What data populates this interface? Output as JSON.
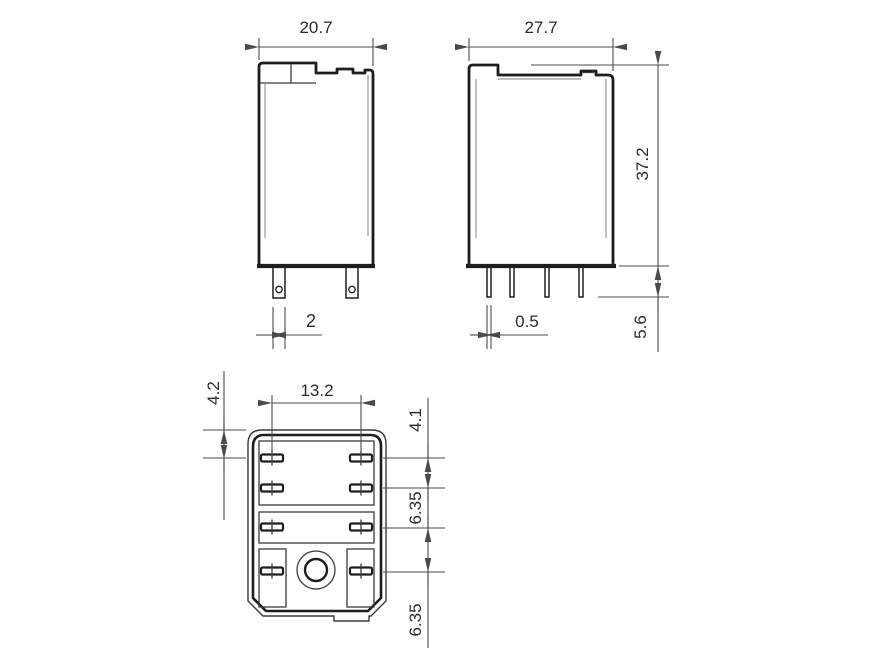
{
  "dims": {
    "front_width": "20.7",
    "front_pin_width": "2",
    "side_width": "27.7",
    "side_height": "37.2",
    "side_pin_thickness": "0.5",
    "side_pin_length": "5.6",
    "bottom_edge_to_row1": "4.2",
    "bottom_column_spacing": "13.2",
    "bottom_row1_to_row2": "4.1",
    "bottom_row2_to_row3": "6.35",
    "bottom_row3_to_row4": "6.35"
  },
  "colors": {
    "line": "#1d1d1b",
    "detail": "#3a3a3a",
    "wall": "#9a9a9a",
    "dim": "#4a4a4a",
    "text": "#2b2b2b",
    "background": "#ffffff"
  }
}
